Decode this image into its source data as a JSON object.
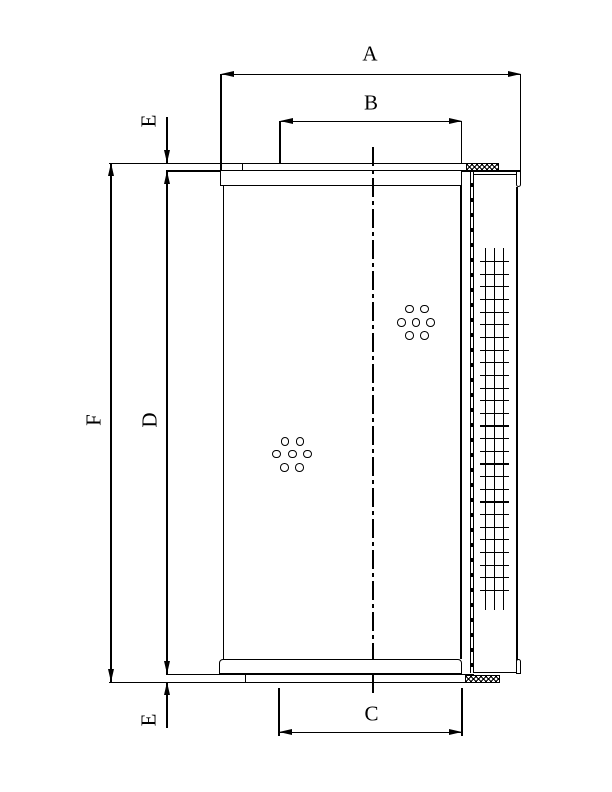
{
  "drawing": {
    "dimension_labels": {
      "a": "A",
      "b": "B",
      "c": "C",
      "d": "D",
      "f": "F",
      "e_top": "E",
      "e_bottom": "E"
    },
    "colors": {
      "line": "#000000",
      "background": "#ffffff"
    }
  }
}
